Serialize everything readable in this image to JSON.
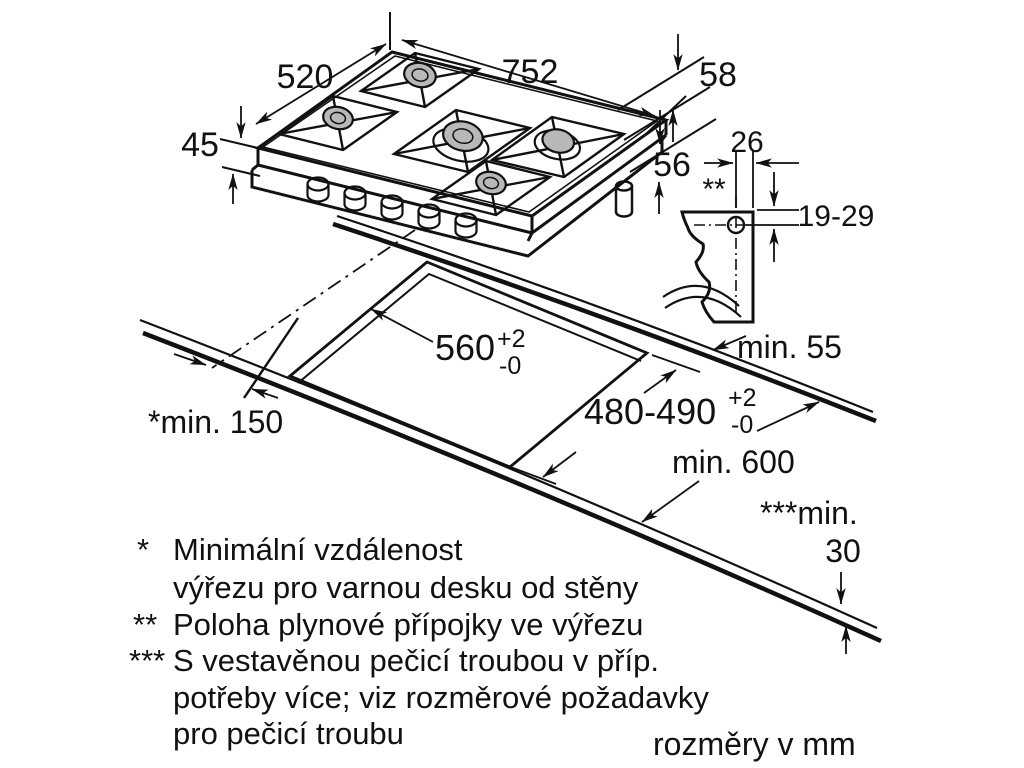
{
  "hob": {
    "d520": "520",
    "d752": "752",
    "d45": "45",
    "d58": "58",
    "d56": "56"
  },
  "gas": {
    "d26": "26",
    "stars": "**",
    "d1929": "19-29"
  },
  "cutout": {
    "w": "560",
    "w_sup": "+2",
    "w_sub": "-0",
    "d": "480-490",
    "d_sup": "+2",
    "d_sub": "-0"
  },
  "clear": {
    "left": "*min. 150",
    "back": "min. 55",
    "depth": "min. 600",
    "front1": "***min.",
    "front2": "30"
  },
  "notes": {
    "m1": "*",
    "t1a": "Minimální vzdálenost",
    "t1b": "výřezu pro varnou desku od stěny",
    "m2": "**",
    "t2a": "Poloha plynové přípojky ve výřezu",
    "m3": "***",
    "t3a": "S vestavěnou pečicí troubou v příp.",
    "t3b": "potřeby více; viz rozměrové požadavky",
    "t3c": "pro pečicí troubu",
    "units": "rozměry v mm"
  }
}
